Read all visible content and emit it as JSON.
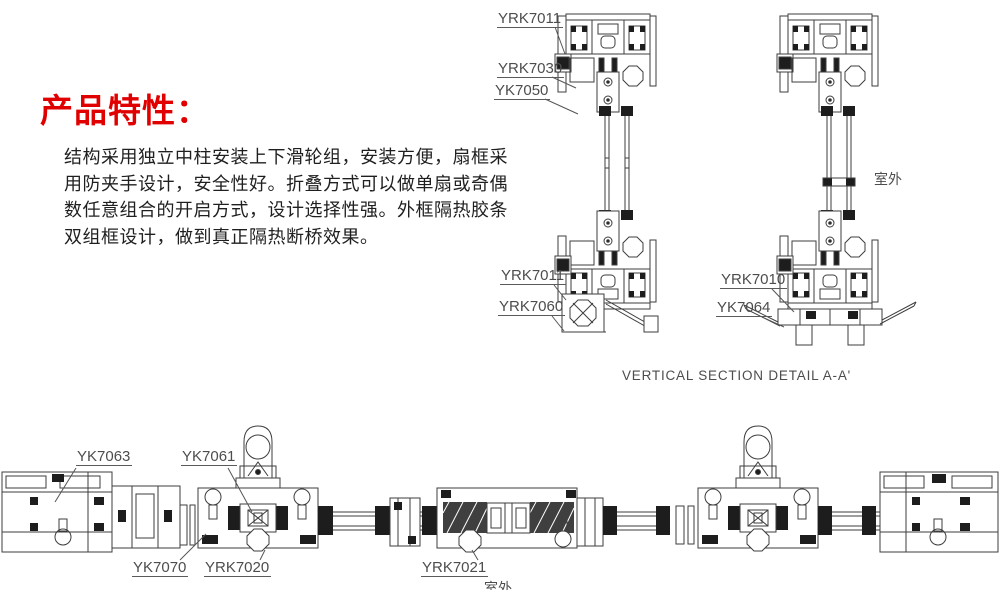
{
  "features": {
    "heading": "产品特性：",
    "paragraph_lines": [
      "结构采用独立中柱安装上下滑轮组，安装方便，扇框采",
      "用防夹手设计，安全性好。折叠方式可以做单扇或奇偶",
      "数任意组合的开启方式，设计选择性强。外框隔热胶条",
      "双组框设计，做到真正隔热断桥效果。"
    ]
  },
  "vertical_section": {
    "caption": "VERTICAL SECTION DETAIL A-A'",
    "outdoor_label": "室外",
    "labels": {
      "head_track": "YRK7011",
      "carrier_block": "YRK7030",
      "track_cover": "YK7050",
      "bottom_track": "YRK7011",
      "sill_adapter": "YRK7060",
      "right_bottom_track": "YRK7010",
      "right_sill": "YK7064"
    }
  },
  "horizontal_section": {
    "outdoor_label": "室外",
    "labels": {
      "frame_jamb": "YK7063",
      "hinge_pivot": "YK7061",
      "sash_profile": "YK7070",
      "fold_joint": "YRK7020",
      "meeting_stile": "YRK7021"
    }
  },
  "colors": {
    "accent_red": "#e00000",
    "line_gray": "#3d3d3d",
    "label_gray": "#4d4d4d"
  }
}
